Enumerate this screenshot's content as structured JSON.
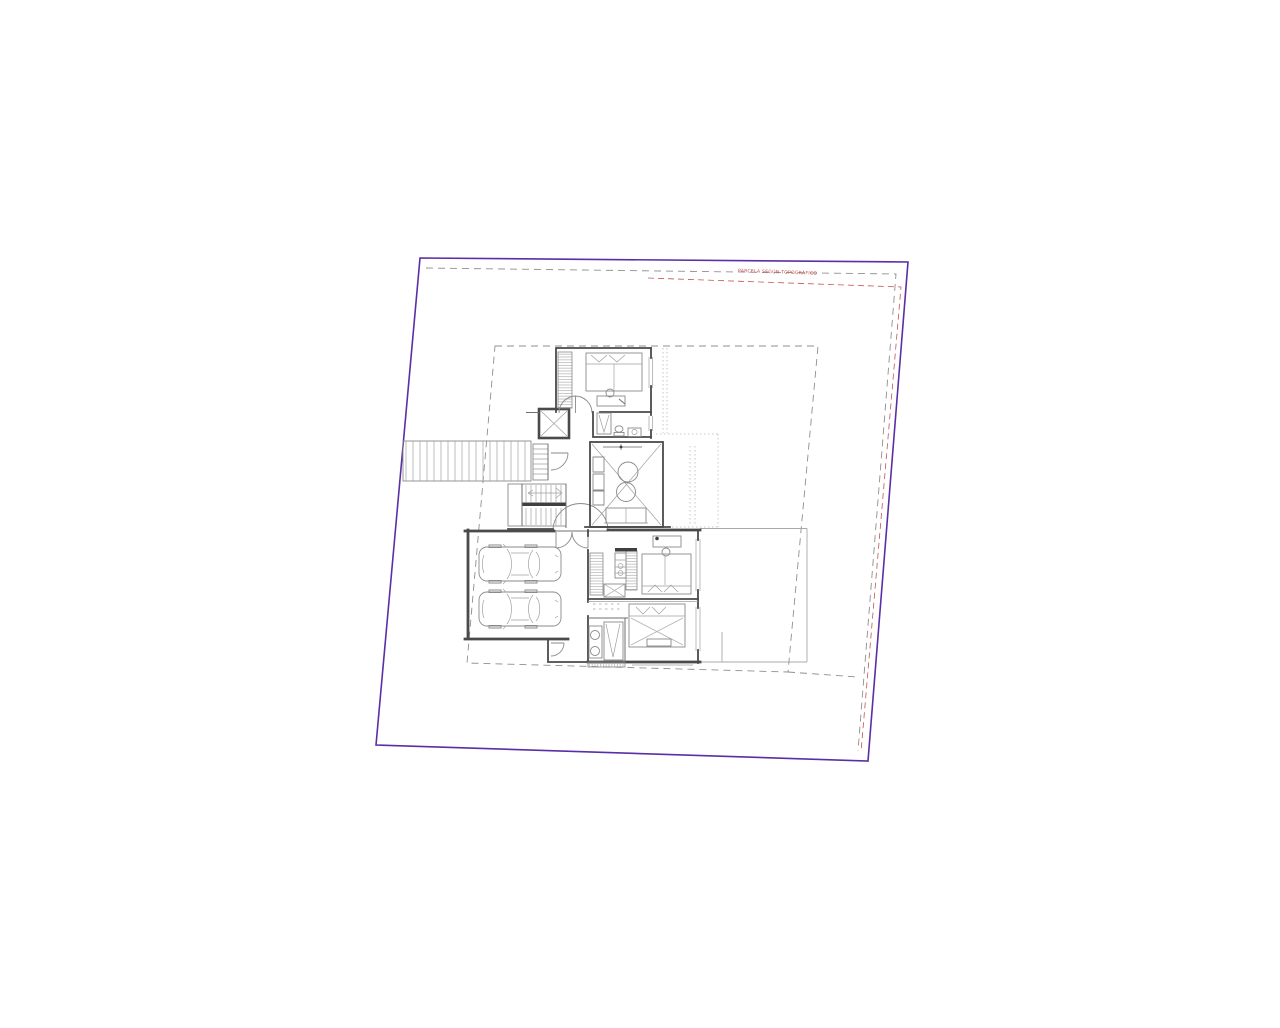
{
  "page": {
    "background": "#ffffff"
  },
  "colors": {
    "boundary": "#5a2ea6",
    "survey": "#c25555",
    "surveyText": "#c05050",
    "dash": "#8f8f8f",
    "wall": "#4a4a4a",
    "fixture": "#8a8a8a",
    "faint": "#b8b8b8"
  },
  "annotations": {
    "boundary_label": "PARCELA SEGÚN TOPOGRÁFICO"
  },
  "plan": {
    "elements": [
      "site-boundary",
      "offset-boundary",
      "survey-boundary",
      "building-setback",
      "driveway-ramp",
      "service-stair",
      "elevator-shaft",
      "upper-bedroom-suite",
      "upper-bathroom",
      "main-stair",
      "entrance-door",
      "double-height-void",
      "garage",
      "car",
      "car",
      "middle-bedroom",
      "lower-bedroom",
      "lower-bathroom",
      "storage-room",
      "terrace"
    ]
  }
}
